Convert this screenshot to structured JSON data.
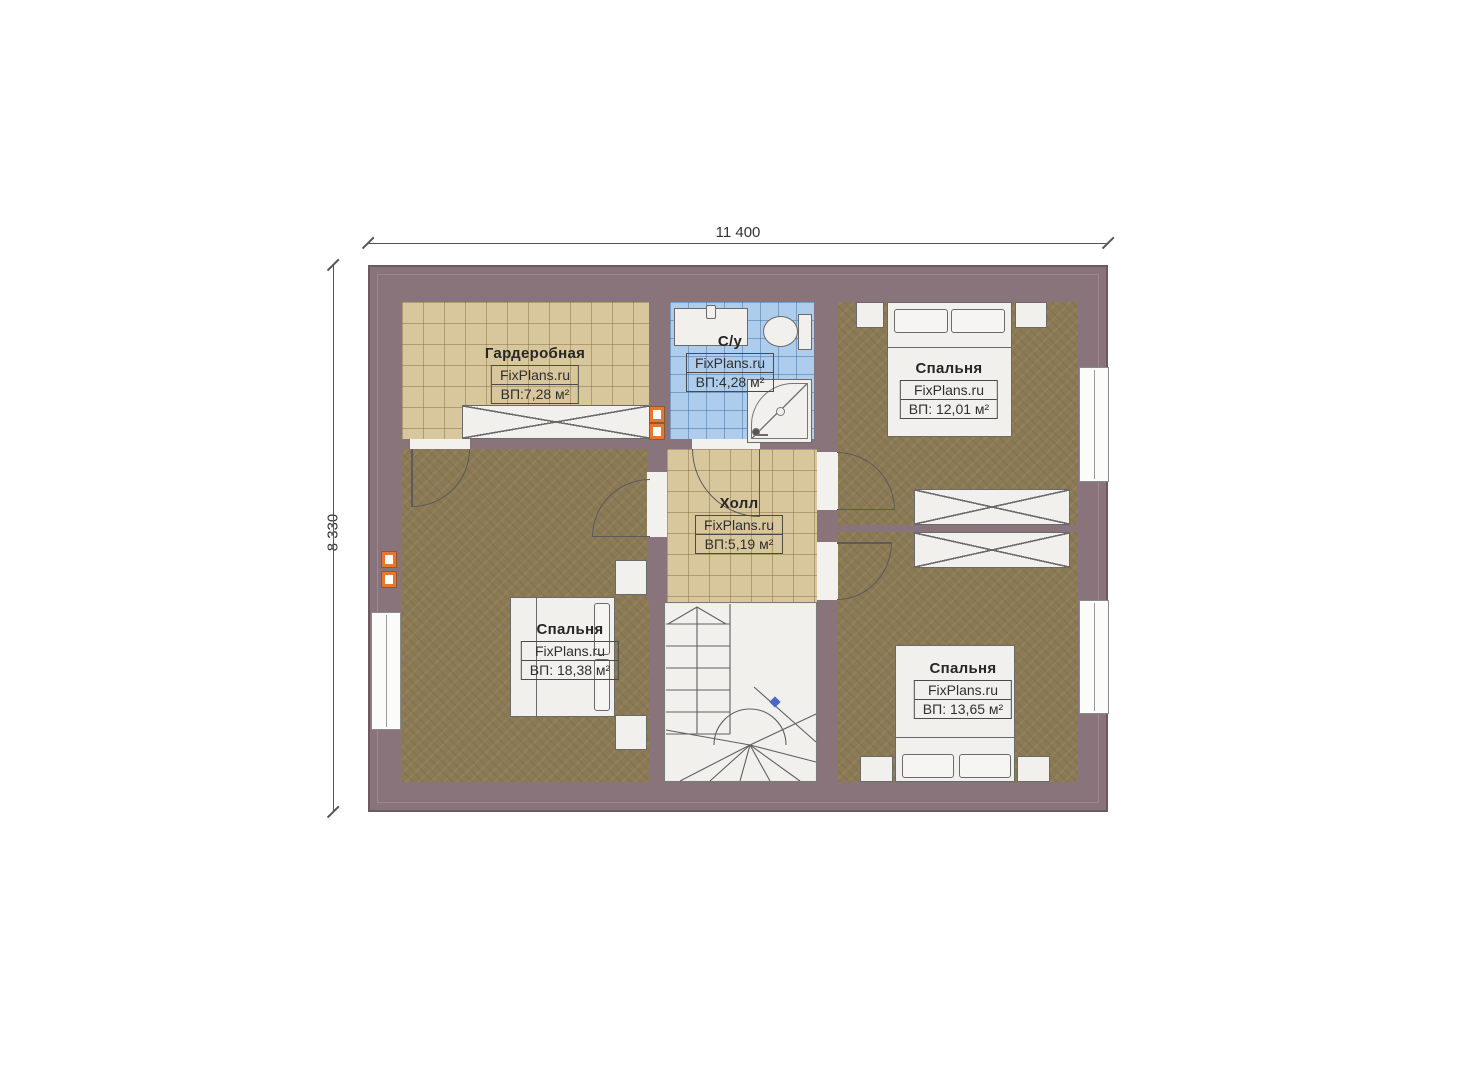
{
  "plan": {
    "width_dim": "11 400",
    "height_dim": "8 330",
    "rooms": [
      {
        "name": "Гардеробная",
        "brand": "FixPlans.ru",
        "area": "ВП:7,28 м²"
      },
      {
        "name": "С/у",
        "brand": "FixPlans.ru",
        "area": "ВП:4,28 м²"
      },
      {
        "name": "Спальня",
        "brand": "FixPlans.ru",
        "area": "ВП: 12,01 м²"
      },
      {
        "name": "Холл",
        "brand": "FixPlans.ru",
        "area": "ВП:5,19 м²"
      },
      {
        "name": "Спальня",
        "brand": "FixPlans.ru",
        "area": "ВП: 18,38 м²"
      },
      {
        "name": "Спальня",
        "brand": "FixPlans.ru",
        "area": "ВП: 13,65 м²"
      }
    ],
    "colors": {
      "wall": "#8a747b",
      "carpet": "#8c7a55",
      "tile_beige": "#d8c69c",
      "tile_blue": "#aecdec",
      "accent_orange": "#e8762c",
      "stair_marker_blue": "#4a66c8"
    }
  }
}
